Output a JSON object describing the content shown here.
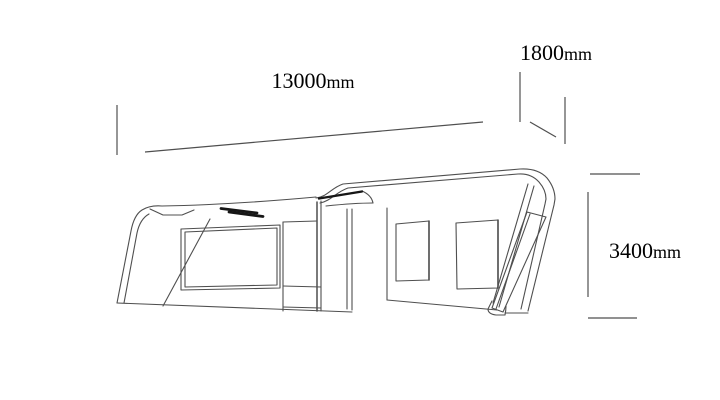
{
  "page": {
    "background_color": "#ffffff",
    "description": "Technical side-view line drawing of a vehicle with dimension callouts"
  },
  "drawing": {
    "line_color": "#4f4f4f",
    "dark_accent_color": "#161616",
    "text_color": "#000000",
    "dimensions": {
      "length": {
        "value": "13000",
        "unit": "mm"
      },
      "width": {
        "value": "1800",
        "unit": "mm"
      },
      "height": {
        "value": "3400",
        "unit": "mm"
      }
    }
  }
}
